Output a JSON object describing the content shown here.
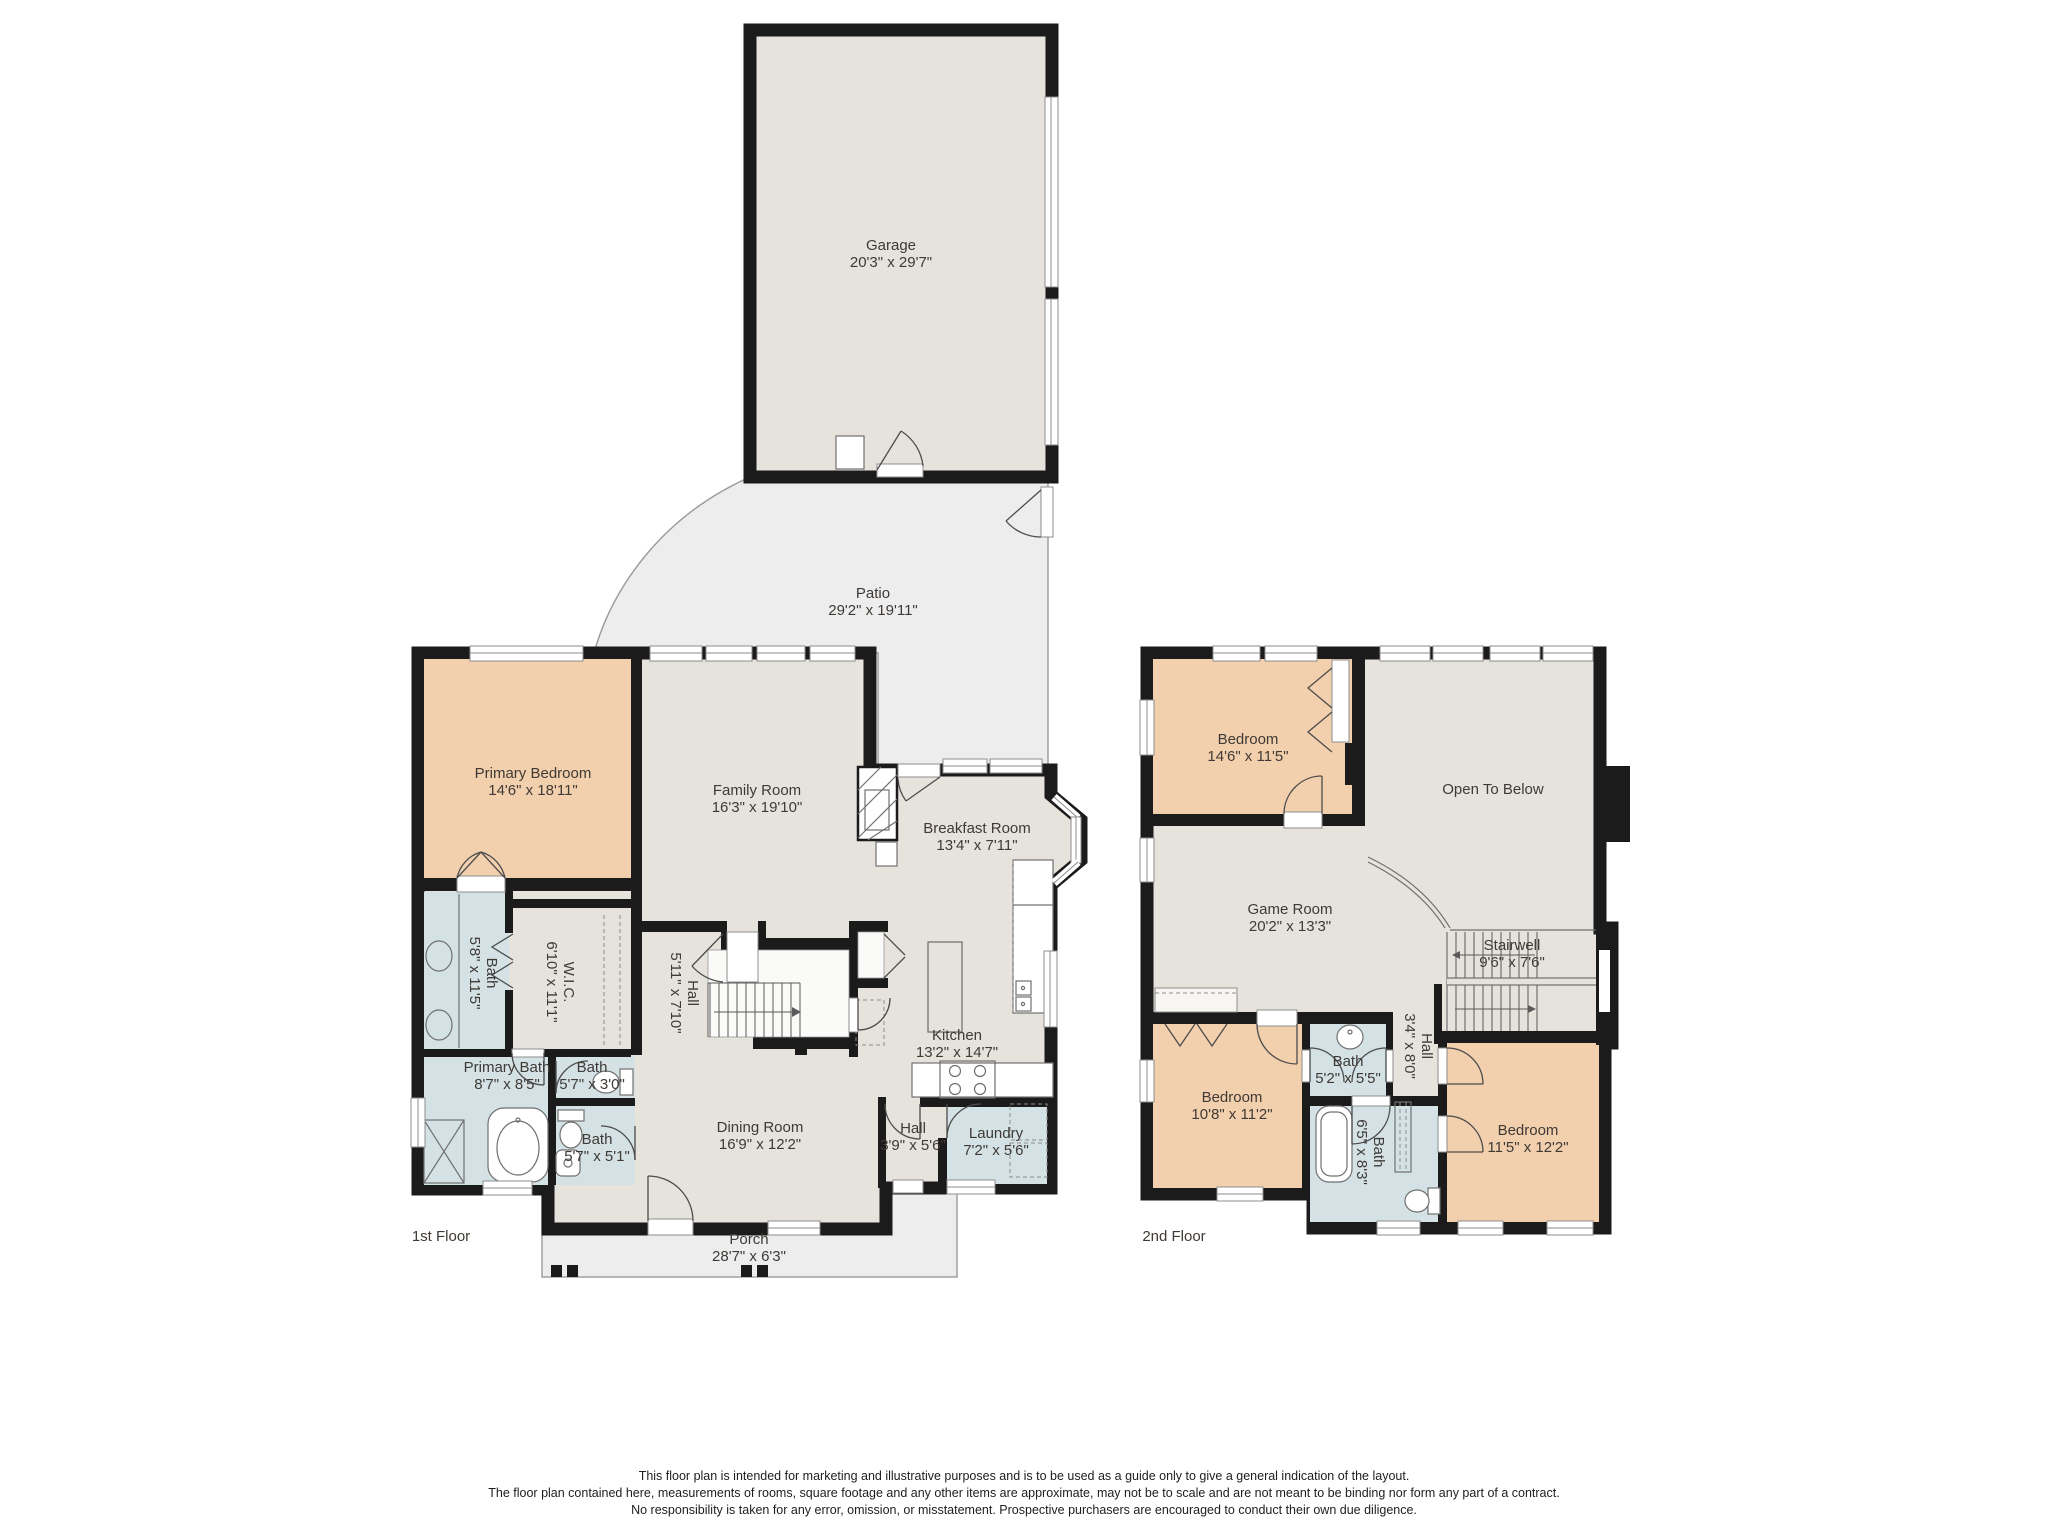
{
  "floor1": {
    "label": "1st Floor",
    "garage": {
      "name": "Garage",
      "dims": "20'3\" x 29'7\""
    },
    "patio": {
      "name": "Patio",
      "dims": "29'2\" x 19'11\""
    },
    "primary_bedroom": {
      "name": "Primary Bedroom",
      "dims": "14'6\" x 18'11\""
    },
    "family_room": {
      "name": "Family Room",
      "dims": "16'3\" x 19'10\""
    },
    "breakfast_room": {
      "name": "Breakfast Room",
      "dims": "13'4\" x 7'11\""
    },
    "bath_vanity": {
      "name": "Bath",
      "dims": "5'8\" x 11'5\""
    },
    "wic": {
      "name": "W.I.C.",
      "dims": "6'10\" x 11'1\""
    },
    "stair_hall": {
      "name": "Hall",
      "dims": "5'11\" x 7'10\""
    },
    "primary_bath": {
      "name": "Primary Bath",
      "dims": "8'7\" x 8'5\""
    },
    "bath_toilet": {
      "name": "Bath",
      "dims": "5'7\" x 3'0\""
    },
    "bath_lower": {
      "name": "Bath",
      "dims": "5'7\" x 5'1\""
    },
    "kitchen": {
      "name": "Kitchen",
      "dims": "13'2\" x 14'7\""
    },
    "dining_room": {
      "name": "Dining Room",
      "dims": "16'9\" x 12'2\""
    },
    "entry_hall": {
      "name": "Hall",
      "dims": "3'9\" x 5'6\""
    },
    "laundry": {
      "name": "Laundry",
      "dims": "7'2\" x 5'6\""
    },
    "porch": {
      "name": "Porch",
      "dims": "28'7\" x 6'3\""
    }
  },
  "floor2": {
    "label": "2nd Floor",
    "bedroom_top": {
      "name": "Bedroom",
      "dims": "14'6\" x 11'5\""
    },
    "open_to_below": {
      "name": "Open To Below"
    },
    "game_room": {
      "name": "Game Room",
      "dims": "20'2\" x 13'3\""
    },
    "stairwell": {
      "name": "Stairwell",
      "dims": "9'6\" x 7'6\""
    },
    "bedroom_left": {
      "name": "Bedroom",
      "dims": "10'8\" x 11'2\""
    },
    "bath_small": {
      "name": "Bath",
      "dims": "5'2\" x 5'5\""
    },
    "hall": {
      "name": "Hall",
      "dims": "3'4\" x 8'0\""
    },
    "bath_tub": {
      "name": "Bath",
      "dims": "6'5\" x 8'3\""
    },
    "bedroom_right": {
      "name": "Bedroom",
      "dims": "11'5\" x 12'2\""
    }
  },
  "disclaimer": {
    "line1": "This floor plan is intended for marketing and illustrative purposes and is to be used as a guide only to give a general indication of the layout.",
    "line2": "The floor plan contained here, measurements of rooms, square footage and any other items are approximate, may not be to scale and are not meant to be binding nor form any part of a contract.",
    "line3": "No responsibility is taken for any error, omission, or misstatement. Prospective purchasers are encouraged to conduct their own due diligence."
  }
}
